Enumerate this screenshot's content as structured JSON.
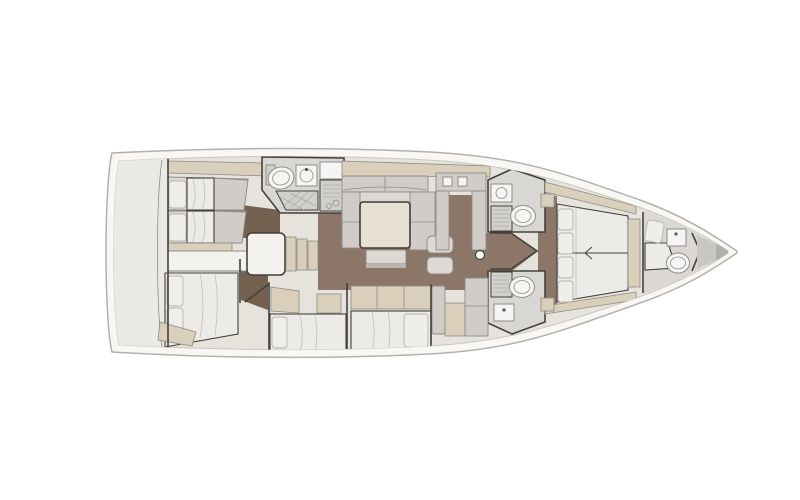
{
  "diagram": {
    "type": "floorplan",
    "subject": "sailing-yacht-interior-deck-plan",
    "orientation": "bow-right",
    "regions": [
      {
        "name": "aft-locker"
      },
      {
        "name": "port-aft-cabin-twin-berths"
      },
      {
        "name": "aft-head-with-shower"
      },
      {
        "name": "companionway-steps"
      },
      {
        "name": "saloon-sofa-and-table"
      },
      {
        "name": "chart-station"
      },
      {
        "name": "mast-post"
      },
      {
        "name": "port-mid-head"
      },
      {
        "name": "starboard-mid-head"
      },
      {
        "name": "starboard-aft-cabin"
      },
      {
        "name": "starboard-guest-cabin-mid"
      },
      {
        "name": "starboard-guest-cabin-fwd"
      },
      {
        "name": "galley-units"
      },
      {
        "name": "owner-cabin-island-bed"
      },
      {
        "name": "forepeak-crew-cabin"
      },
      {
        "name": "anchor-locker"
      }
    ]
  },
  "colors": {
    "background": "#ffffff",
    "hull_deck": "#f8f7f4",
    "hull_outline": "#b3b1ae",
    "inner_line": "#c9c7c3",
    "interior_base": "#e6e3dd",
    "lazarette": "#ebe9e5",
    "floor_wood": "#8c7667",
    "floor_wood_dark": "#73604f",
    "furniture_beige": "#d9cfba",
    "furniture_gray": "#d0cdc8",
    "upholstery": "#dcd9d4",
    "bedding": "#edebe7",
    "pillow": "#f0eee9",
    "pillow_edge": "#b5b3af",
    "fixture_white": "#f6f5f3",
    "fixture_edge": "#8e8c88",
    "panel_fill": "#d2d0cc",
    "panel_lines": "#8e8b86",
    "head_floor": "#d9d7d3",
    "passage_white": "#f4f2ef",
    "locker_gray": "#c9c7c3",
    "bow_tip": "#b1afac",
    "wall": "#44403a",
    "fold_line": "#c2c0bc",
    "grid_line": "#aeaca8"
  }
}
